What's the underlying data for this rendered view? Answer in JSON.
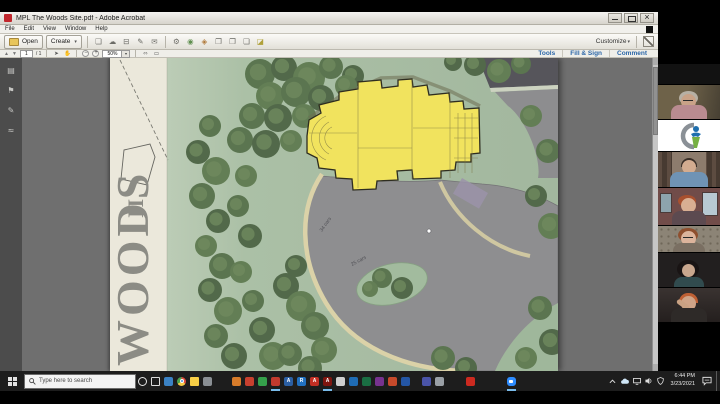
{
  "window": {
    "title": "MPL The Woods Site.pdf - Adobe Acrobat",
    "menus": [
      "File",
      "Edit",
      "View",
      "Window",
      "Help"
    ],
    "open_label": "Open",
    "create_label": "Create",
    "customize_label": "Customize",
    "tabs": [
      "Tools",
      "Fill & Sign",
      "Comment"
    ],
    "page_number": "1",
    "page_total": "/ 1",
    "zoom_level": "50%"
  },
  "icons": {
    "toolbar": [
      {
        "name": "save",
        "glyph": "❏"
      },
      {
        "name": "cloud-upload",
        "glyph": "☁"
      },
      {
        "name": "print",
        "glyph": "⊟"
      },
      {
        "name": "sign",
        "glyph": "✎"
      },
      {
        "name": "email",
        "glyph": "✉"
      },
      {
        "name": "gear",
        "glyph": "⚙"
      },
      {
        "name": "comment-cloud",
        "glyph": "◉"
      },
      {
        "name": "stamp",
        "glyph": "◈"
      },
      {
        "name": "doc-attach",
        "glyph": "❐"
      },
      {
        "name": "doc-export",
        "glyph": "❐"
      },
      {
        "name": "doc-new",
        "glyph": "❏"
      },
      {
        "name": "highlight",
        "glyph": "◪"
      }
    ],
    "sidebar": [
      {
        "name": "page-thumbnails",
        "glyph": "▤"
      },
      {
        "name": "bookmarks",
        "glyph": "⚑"
      },
      {
        "name": "attachments",
        "glyph": "✎"
      },
      {
        "name": "signatures",
        "glyph": "≈"
      }
    ]
  },
  "plan": {
    "title_main": "WOODS",
    "title_suffix": "II",
    "parking_label_1": "34 cars",
    "parking_label_2": "25 cars"
  },
  "taskbar": {
    "search_placeholder": "Type here to search",
    "time": "6:44 PM",
    "date": "3/23/2021",
    "icons": [
      {
        "name": "cortana",
        "kind": "ring"
      },
      {
        "name": "task-view",
        "kind": "sq"
      },
      {
        "name": "edge",
        "color": "#3b82c4"
      },
      {
        "name": "chrome",
        "kind": "chrome"
      },
      {
        "name": "file-explorer",
        "kind": "folder"
      },
      {
        "name": "store",
        "color": "#8a8f94"
      },
      {
        "name": "app-orange",
        "color": "#d77c2a",
        "gap_before": 16
      },
      {
        "name": "pdf-red",
        "color": "#c8402f"
      },
      {
        "name": "app-green",
        "color": "#35a14b"
      },
      {
        "name": "app-red",
        "color": "#c23a2e",
        "active": true
      },
      {
        "name": "app-blue",
        "color": "#2b5fa3",
        "label": "A"
      },
      {
        "name": "ringcentral",
        "color": "#2170c0",
        "label": "R"
      },
      {
        "name": "acrobat",
        "color": "#c32f24",
        "label": "A"
      },
      {
        "name": "acrobat-dc",
        "color": "#7e150f",
        "label": "A",
        "active": true
      },
      {
        "name": "app-gray",
        "color": "#cfcfcf"
      },
      {
        "name": "outlook",
        "color": "#1f6cb5"
      },
      {
        "name": "excel",
        "color": "#1a6e43"
      },
      {
        "name": "onenote",
        "color": "#77328f"
      },
      {
        "name": "powerpoint",
        "color": "#c74a2b"
      },
      {
        "name": "word",
        "color": "#2456a5"
      },
      {
        "name": "teams",
        "color": "#4a54a8",
        "gap_before": 8
      },
      {
        "name": "app-slate",
        "color": "#9aa0a6"
      },
      {
        "name": "acrobat-reader",
        "color": "#cc2a20",
        "gap_before": 18
      },
      {
        "name": "zoom",
        "color": "#2d8cff",
        "kind": "zoomapp",
        "active": true,
        "gap_before": 28
      }
    ]
  },
  "colors": {
    "acrobat_tab_blue": "#2b66a8",
    "building_yellow": "#f1e35e",
    "plan_green": "#a5ba9f",
    "parking_gray": "#8e8e90",
    "taskbar_bg": "#1d1d1d",
    "zoom_blue": "#2d8cff"
  }
}
